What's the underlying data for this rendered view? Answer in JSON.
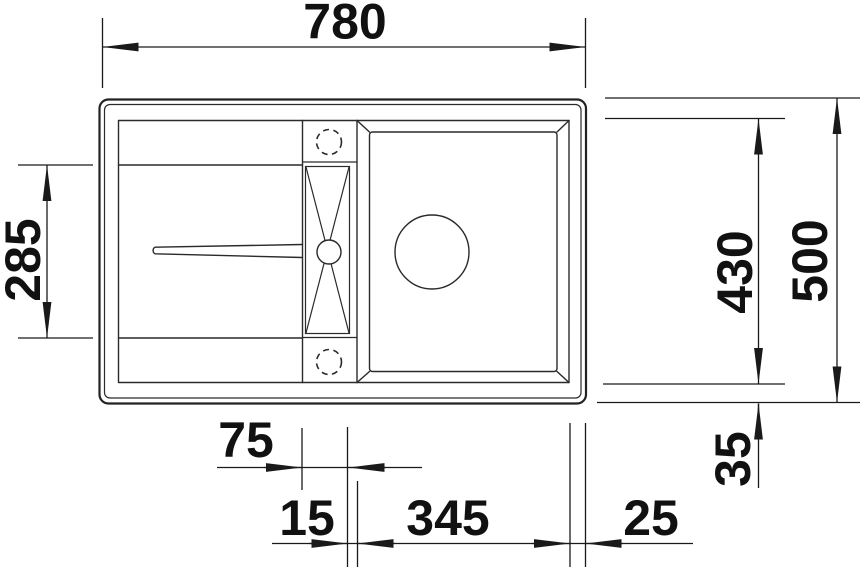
{
  "drawing": {
    "title": "sink-top-view-dimension-drawing",
    "description": "Technical top-view drawing of an inset kitchen sink with left drainboard, centre accessory strip with two tap holes, and right main bowl, annotated with linear dimensions.",
    "colors": {
      "line": "#2a2a2a",
      "dimension": "#1a1a1a",
      "background": "#ffffff"
    },
    "dimensions": {
      "overall_width_top": "780",
      "drainer_depth_left": "285",
      "bowl_depth_right": "430",
      "overall_depth_right": "500",
      "small_bowl_width": "75",
      "divider_width": "15",
      "main_bowl_width": "345",
      "right_margin": "25",
      "bottom_margin": "35"
    }
  }
}
